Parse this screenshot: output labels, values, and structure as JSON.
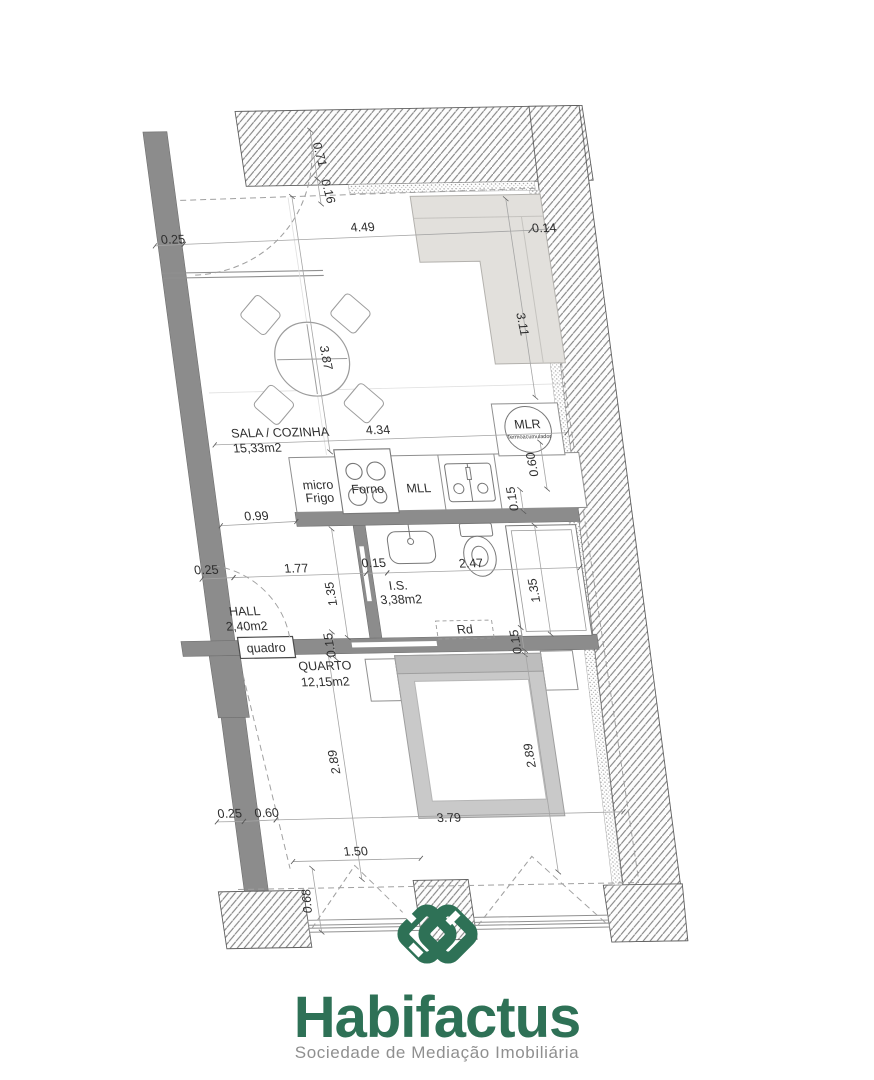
{
  "plan": {
    "rooms": {
      "sala": {
        "name": "SALA / COZINHA",
        "area": "15,33m2"
      },
      "is": {
        "name": "I.S.",
        "area": "3,38m2"
      },
      "hall": {
        "name": "HALL",
        "area": "2,40m2"
      },
      "quarto": {
        "name": "QUARTO",
        "area": "12,15m2"
      }
    },
    "labels": {
      "micro1": "micro",
      "micro2": "Frigo",
      "forno": "Forno",
      "mll": "MLL",
      "mlr": "MLR",
      "mlr_sub": "Termoacumulador",
      "quadro": "quadro",
      "rd": "Rd"
    },
    "dims": {
      "top_setback": "0.71",
      "top_inner": "0.16",
      "left_wall_top": "0.25",
      "living_width": "4.49",
      "right_wall_top": "0.14",
      "sofa_depth": "3.11",
      "living_depth": "3.87",
      "kitchen_width": "4.34",
      "mlr_height": "0.60",
      "mlr_gap": "0.15",
      "hall_top": "0.99",
      "hall_wall": "0.25",
      "hall_width": "1.77",
      "bath_door": "0.15",
      "bath_left": "1.35",
      "bath_width": "2.47",
      "shower_depth": "1.35",
      "divider_left": "0.15",
      "divider_right": "0.15",
      "quarto_left": "2.89",
      "quarto_right": "2.89",
      "bottom_wall": "0.25",
      "bottom_offset": "0.60",
      "quarto_width": "3.79",
      "window_width": "1.50",
      "window_depth": "0.68"
    }
  },
  "logo": {
    "brand": "Habifactus",
    "subtitle": "Sociedade de Mediação Imobiliária",
    "accent": "#2E7156",
    "subtitle_color": "#8F8F8F"
  }
}
